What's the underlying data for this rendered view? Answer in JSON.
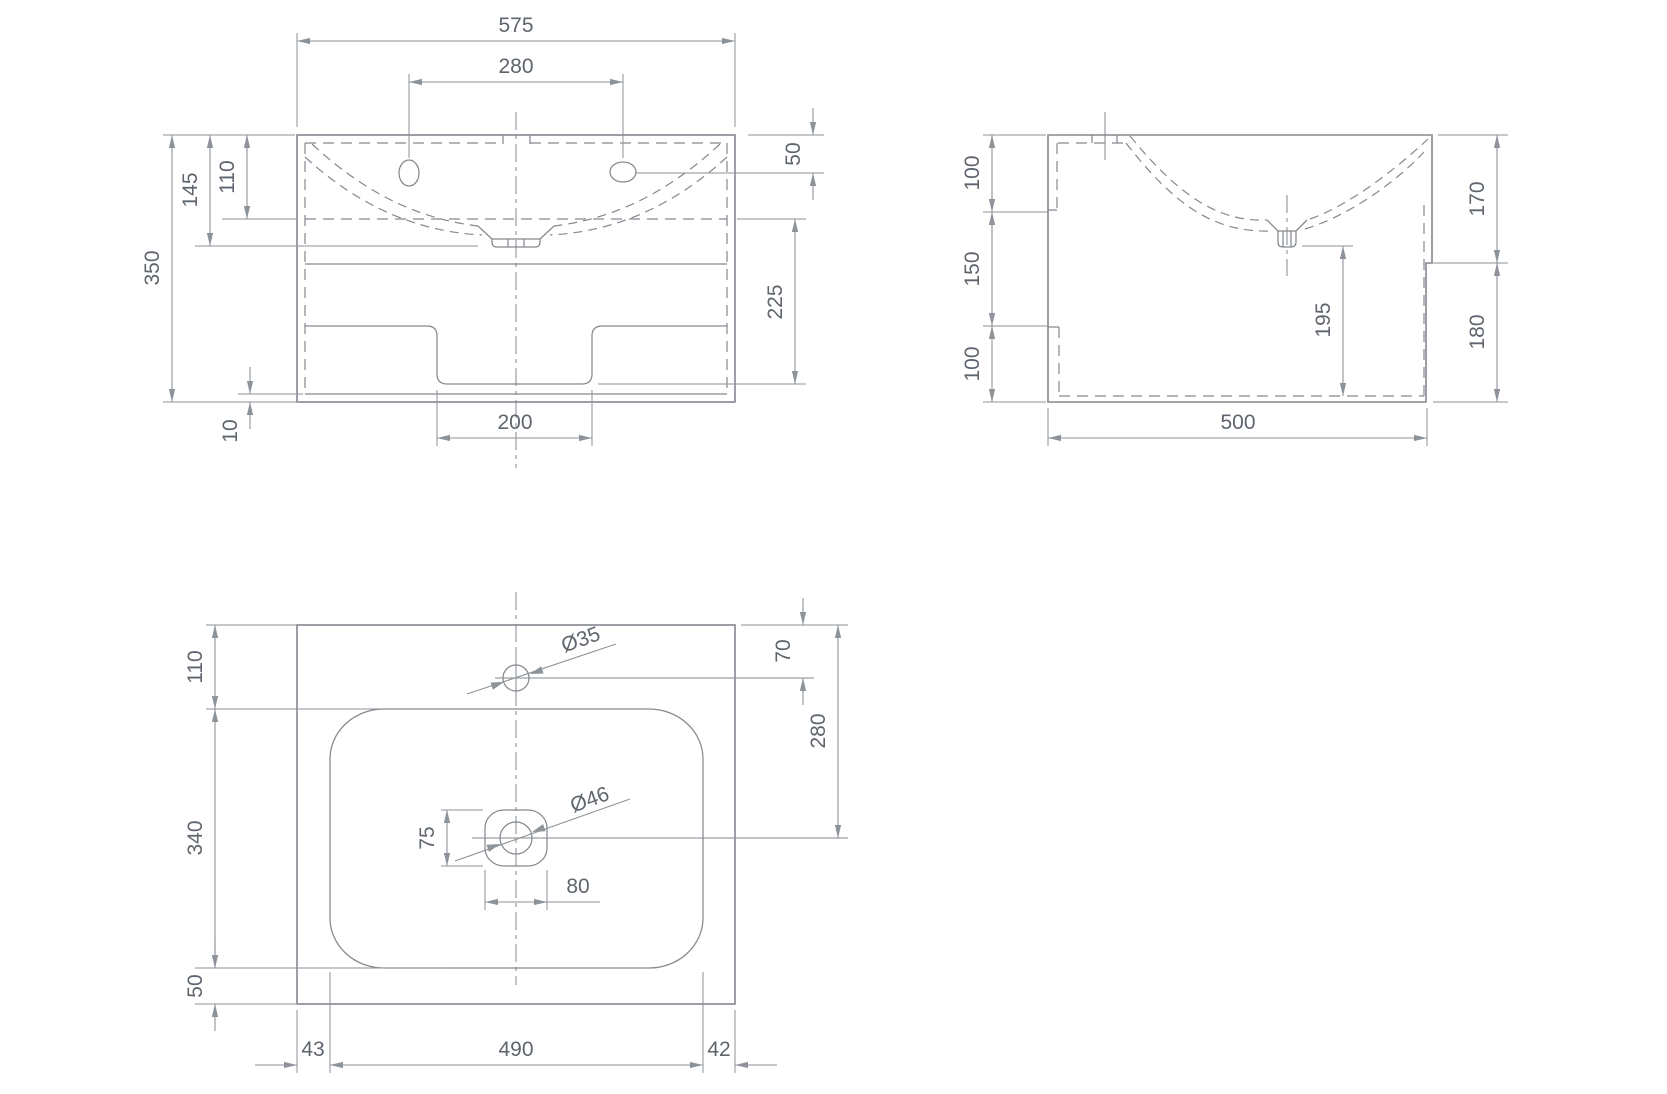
{
  "colors": {
    "line": "#83898f",
    "dim": "#8d9399",
    "text": "#5e656d",
    "background": "#ffffff"
  },
  "front": {
    "overall_width": "575",
    "hole_spacing": "280",
    "basin_depth": "145",
    "deck_level": "110",
    "overall_height": "350",
    "hole_from_top": "50",
    "lower_section": "225",
    "base_thickness": "10",
    "cutout_width": "200"
  },
  "side": {
    "back_top": "100",
    "back_middle": "150",
    "back_bottom": "100",
    "front_upper": "170",
    "front_lower": "180",
    "drain_clearance": "195",
    "overall_depth": "500"
  },
  "plan": {
    "top_margin": "110",
    "basin_length": "340",
    "bottom_margin": "50",
    "left_margin": "43",
    "basin_width": "490",
    "right_margin": "42",
    "faucet_hole_diameter": "Ø35",
    "faucet_from_edge": "70",
    "drain_from_edge": "280",
    "drain_hole_diameter": "Ø46",
    "drain_cutout_height": "75",
    "drain_cutout_width": "80"
  }
}
